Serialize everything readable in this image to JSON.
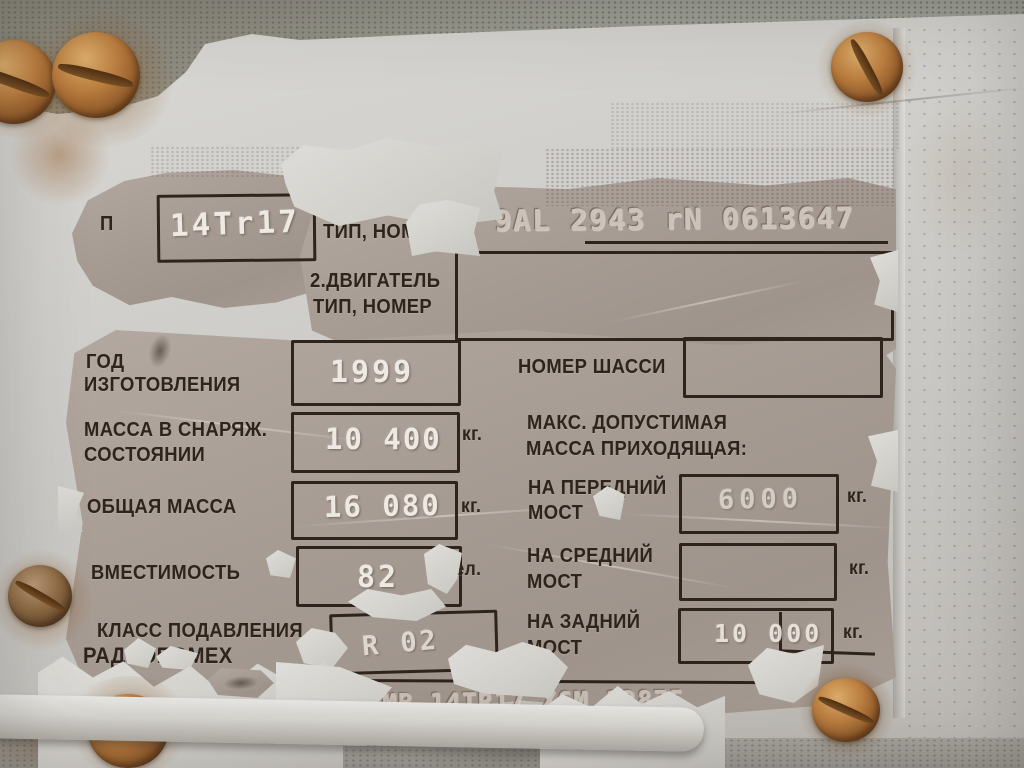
{
  "plate": {
    "row_type": {
      "label_fragment": "П",
      "value": "14Tr17"
    },
    "row_serial": {
      "label": "ТИП, НОМЕР",
      "value": "9AL 2943 rN 0613647"
    },
    "row_engine": {
      "label_line1": "2.ДВИГАТЕЛЬ",
      "label_line2": "ТИП, НОМЕР",
      "value": ""
    },
    "row_year": {
      "label_line1": "ГОД",
      "label_line2": "ИЗГОТОВЛЕНИЯ",
      "value": "1999"
    },
    "row_chassis": {
      "label": "НОМЕР ШАССИ",
      "value": ""
    },
    "row_curb_weight": {
      "label_line1": "МАССА В СНАРЯЖ.",
      "label_line2": "СОСТОЯНИИ",
      "value": "10 400",
      "unit": "кг."
    },
    "heading_max_load": {
      "line1": "МАКС. ДОПУСТИМАЯ",
      "line2": "МАССА ПРИХОДЯЩАЯ:"
    },
    "row_gross_weight": {
      "label": "ОБЩАЯ МАССА",
      "value": "16 080",
      "unit": "кг."
    },
    "row_front_axle": {
      "label_line1": "НА ПЕРЕДНИЙ",
      "label_line2": "МОСТ",
      "value": "6000",
      "unit": "кг."
    },
    "row_capacity": {
      "label": "ВМЕСТИМОСТЬ",
      "value": "82",
      "unit": "чел."
    },
    "row_middle_axle": {
      "label_line1": "НА СРЕДНИЙ",
      "label_line2": "МОСТ",
      "value": "",
      "unit": "кг."
    },
    "row_radio_class": {
      "label_line1": "КЛАСС ПОДАВЛЕНИЯ",
      "label_line2": "РАДИОПОМЕХ",
      "value": "R 02"
    },
    "row_rear_axle": {
      "label_line1": "НА ЗАДНИЙ",
      "label_line2": "МОСТ",
      "value": "10 000",
      "unit": "кг."
    },
    "vin": "TMB 14TR17 X6M 12875"
  },
  "colors": {
    "metal": "#a69b92",
    "paint": "#d2d0cb",
    "ink": "#2e241c",
    "stamp_white": "#eee9e2",
    "rust": "#bb7e40"
  }
}
